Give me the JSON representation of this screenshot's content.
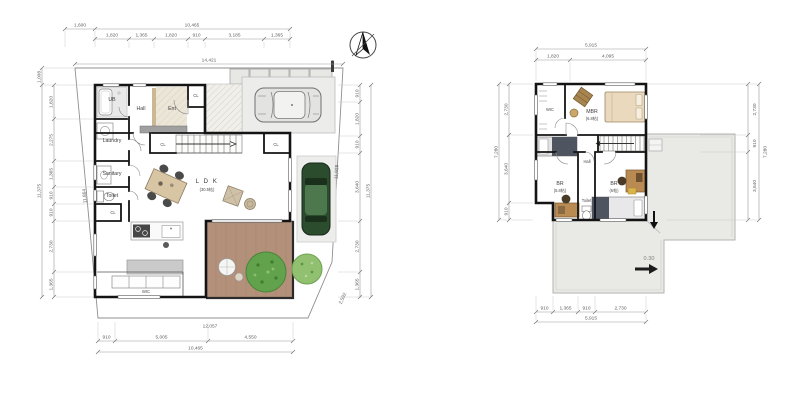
{
  "title": "House floor plans - 1F site plan and 2F plan",
  "colors": {
    "wall": "#141414",
    "deck_brown": "#b3907a",
    "tree_green_dark": "#62a24c",
    "tree_green_light": "#90c070",
    "car_green": "#2c4c2e",
    "roof_gray": "#e9e9e6",
    "overhang_gray": "#a0a0a0"
  },
  "floor1": {
    "dims": {
      "top_offset": "1,600",
      "top_total": "10,465",
      "top_subs": [
        "1,820",
        "1,365",
        "1,820",
        "910",
        "3,185",
        "1,365"
      ],
      "site_top": "14,421",
      "left_offset": "1,008",
      "left_subs": [
        "1,820",
        "2,275",
        "1,365",
        "910",
        "910",
        "2,730",
        "1,365"
      ],
      "left_total": "11,375",
      "right_subs": [
        "910",
        "1,820",
        "910",
        "3,640",
        "2,730",
        "1,365"
      ],
      "right_total": "11,375",
      "slant_left": "11,864",
      "slant_right": "11,928",
      "site_bottom": "12,057",
      "corner_cut": "2,592",
      "bottom_subs": [
        "910",
        "5,005",
        "4,550"
      ],
      "bottom_total": "10,465"
    },
    "rooms": {
      "ub": "UB",
      "hall": "Hall",
      "ent": "Ent",
      "ent_closet": "CL",
      "laundry": "Laundry",
      "sanitary": "Sanitary",
      "toilet": "Toilet",
      "closet_south": "CL",
      "closet_stair_left": "CL",
      "closet_stair_right": "CL",
      "ldk": "L D K",
      "ldk_size": "(30.5帖)",
      "wic": "WIC"
    }
  },
  "floor2": {
    "dims": {
      "top_total": "5,915",
      "top_subs": [
        "1,820",
        "4,095"
      ],
      "left_subs": [
        "2,730",
        "3,640",
        "910"
      ],
      "left_total": "7,280",
      "right_subs": [
        "2,730",
        "910",
        "3,640"
      ],
      "right_total": "7,280",
      "bottom_subs": [
        "910",
        "1,365",
        "910",
        "2,730"
      ],
      "bottom_total": "5,915"
    },
    "rooms": {
      "wic": "WIC",
      "mbr": "MBR",
      "mbr_size": "(6.8帖)",
      "hall": "Hall",
      "br1": "BR",
      "br1_size": "(5.8帖)",
      "toilet": "Toilet",
      "br2": "BR",
      "br2_size": "(6帖)"
    },
    "roof_slope": "0.30"
  }
}
